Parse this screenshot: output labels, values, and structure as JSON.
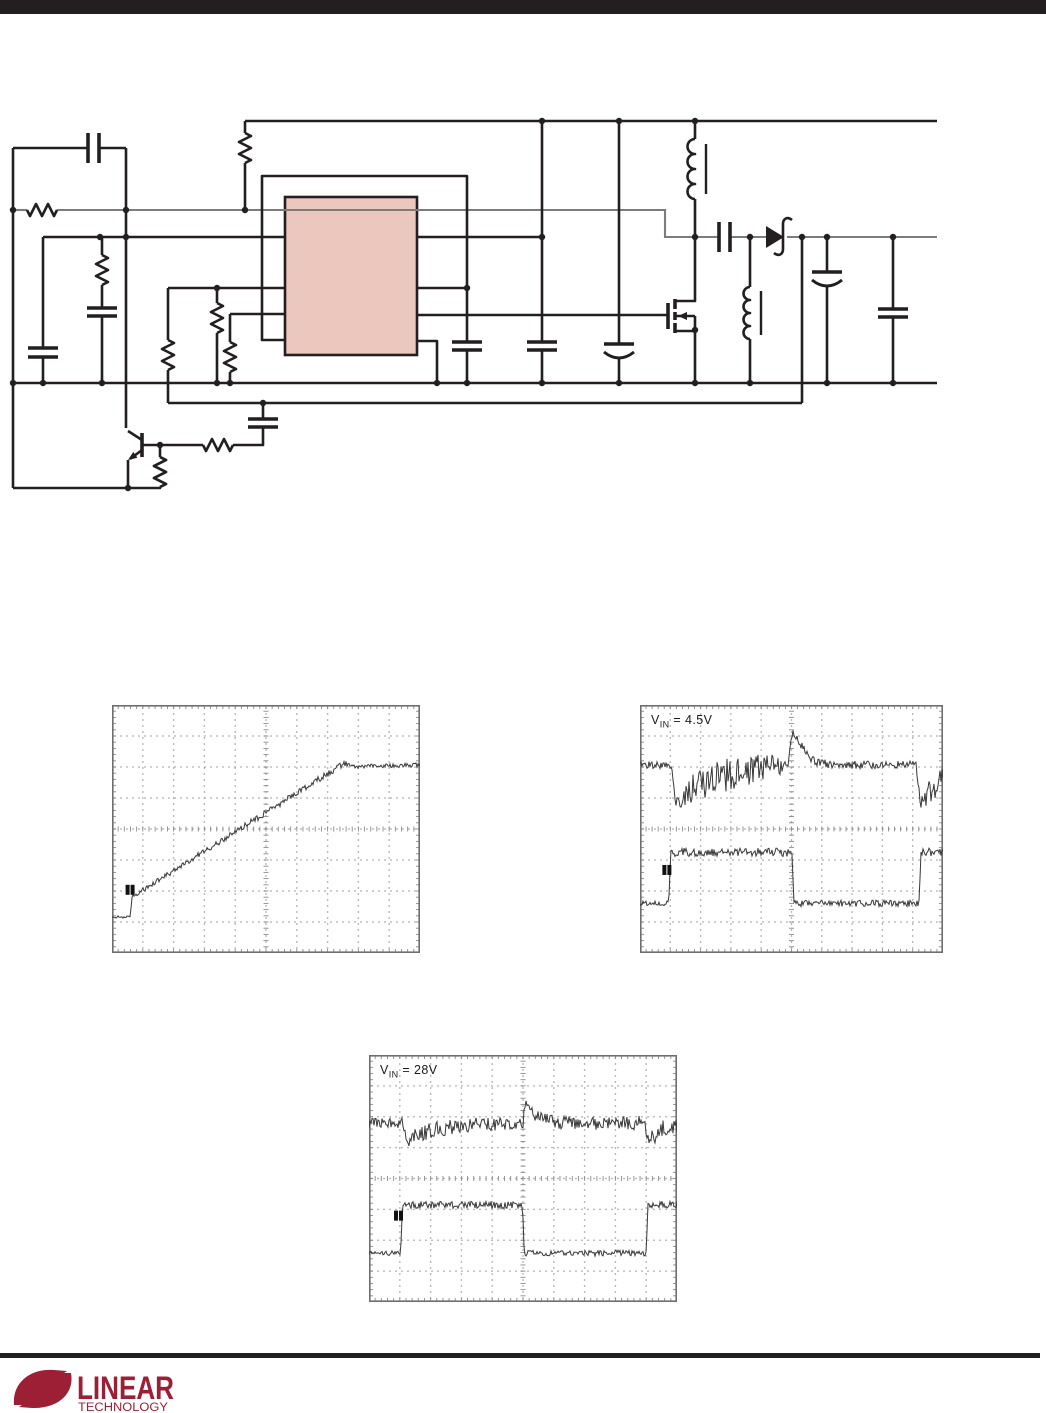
{
  "page": {
    "background": "#ffffff",
    "rule_color": "#231f20"
  },
  "schematic": {
    "ic_fill": "#EBC7BE",
    "wire_color": "#231f20",
    "highlight_net_color": "#7c7c7c",
    "description": "switching regulator application schematic, unlabeled"
  },
  "chart_data": [
    {
      "type": "line",
      "subtype": "oscilloscope",
      "name": "soft-start-ramp",
      "label": null,
      "divisions": {
        "cols": 10,
        "rows": 8
      },
      "grid": "dotted",
      "traces": [
        {
          "name": "output-ramp",
          "seed": 11,
          "points": [
            {
              "x": 0,
              "y": 0.855,
              "n": 0.006
            },
            {
              "x": 0.06,
              "y": 0.855,
              "n": 0.006
            },
            {
              "x": 0.064,
              "y": 0.775,
              "n": 0.01
            },
            {
              "x": 0.755,
              "y": 0.234,
              "n": 0.013
            },
            {
              "x": 0.775,
              "y": 0.248,
              "n": 0.008
            },
            {
              "x": 1,
              "y": 0.242,
              "n": 0.009
            }
          ]
        }
      ],
      "trigger": {
        "x": 0.062,
        "y": 0.725
      }
    },
    {
      "type": "line",
      "subtype": "oscilloscope",
      "name": "load-transient-vin-4p5",
      "label": {
        "v": "V",
        "sub": "IN",
        "rest": " = 4.5V"
      },
      "divisions": {
        "cols": 10,
        "rows": 8
      },
      "grid": "dotted",
      "traces": [
        {
          "name": "output-voltage",
          "seed": 23,
          "points": [
            {
              "x": 0,
              "y": 0.242,
              "n": 0.014
            },
            {
              "x": 0.105,
              "y": 0.242,
              "n": 0.014
            },
            {
              "x": 0.118,
              "y": 0.395,
              "n": 0.025
            },
            {
              "x": 0.16,
              "y": 0.35,
              "n": 0.06
            },
            {
              "x": 0.27,
              "y": 0.285,
              "n": 0.068
            },
            {
              "x": 0.42,
              "y": 0.25,
              "n": 0.055
            },
            {
              "x": 0.49,
              "y": 0.245,
              "n": 0.03
            },
            {
              "x": 0.503,
              "y": 0.105,
              "n": 0.015
            },
            {
              "x": 0.52,
              "y": 0.14,
              "n": 0.015
            },
            {
              "x": 0.57,
              "y": 0.225,
              "n": 0.018
            },
            {
              "x": 0.63,
              "y": 0.242,
              "n": 0.016
            },
            {
              "x": 0.912,
              "y": 0.242,
              "n": 0.016
            },
            {
              "x": 0.925,
              "y": 0.4,
              "n": 0.025
            },
            {
              "x": 0.95,
              "y": 0.36,
              "n": 0.055
            },
            {
              "x": 1,
              "y": 0.3,
              "n": 0.05
            }
          ]
        },
        {
          "name": "load-current-step",
          "seed": 31,
          "points": [
            {
              "x": 0,
              "y": 0.8,
              "n": 0.01
            },
            {
              "x": 0.095,
              "y": 0.8,
              "n": 0.01
            },
            {
              "x": 0.101,
              "y": 0.594,
              "n": 0.017
            },
            {
              "x": 0.502,
              "y": 0.594,
              "n": 0.017
            },
            {
              "x": 0.508,
              "y": 0.8,
              "n": 0.013
            },
            {
              "x": 0.921,
              "y": 0.8,
              "n": 0.013
            },
            {
              "x": 0.927,
              "y": 0.594,
              "n": 0.017
            },
            {
              "x": 1,
              "y": 0.594,
              "n": 0.017
            }
          ]
        }
      ],
      "trigger": {
        "x": 0.092,
        "y": 0.645
      }
    },
    {
      "type": "line",
      "subtype": "oscilloscope",
      "name": "load-transient-vin-28",
      "label": {
        "v": "V",
        "sub": "IN",
        "rest": " = 28V"
      },
      "divisions": {
        "cols": 10,
        "rows": 8
      },
      "grid": "dotted",
      "traces": [
        {
          "name": "output-voltage",
          "seed": 43,
          "points": [
            {
              "x": 0,
              "y": 0.275,
              "n": 0.02
            },
            {
              "x": 0.11,
              "y": 0.275,
              "n": 0.02
            },
            {
              "x": 0.125,
              "y": 0.34,
              "n": 0.03
            },
            {
              "x": 0.21,
              "y": 0.3,
              "n": 0.034
            },
            {
              "x": 0.36,
              "y": 0.283,
              "n": 0.03
            },
            {
              "x": 0.5,
              "y": 0.272,
              "n": 0.024
            },
            {
              "x": 0.508,
              "y": 0.185,
              "n": 0.015
            },
            {
              "x": 0.535,
              "y": 0.24,
              "n": 0.024
            },
            {
              "x": 0.62,
              "y": 0.275,
              "n": 0.028
            },
            {
              "x": 0.895,
              "y": 0.275,
              "n": 0.028
            },
            {
              "x": 0.91,
              "y": 0.345,
              "n": 0.03
            },
            {
              "x": 0.95,
              "y": 0.3,
              "n": 0.034
            },
            {
              "x": 1,
              "y": 0.285,
              "n": 0.03
            }
          ]
        },
        {
          "name": "load-current-step",
          "seed": 57,
          "points": [
            {
              "x": 0,
              "y": 0.802,
              "n": 0.01
            },
            {
              "x": 0.103,
              "y": 0.802,
              "n": 0.01
            },
            {
              "x": 0.109,
              "y": 0.607,
              "n": 0.015
            },
            {
              "x": 0.498,
              "y": 0.607,
              "n": 0.015
            },
            {
              "x": 0.504,
              "y": 0.802,
              "n": 0.012
            },
            {
              "x": 0.9,
              "y": 0.802,
              "n": 0.012
            },
            {
              "x": 0.906,
              "y": 0.607,
              "n": 0.015
            },
            {
              "x": 1,
              "y": 0.607,
              "n": 0.015
            }
          ]
        }
      ],
      "trigger": {
        "x": 0.099,
        "y": 0.63
      }
    }
  ],
  "logo": {
    "brand": "LINEAR",
    "sub": "TECHNOLOGY",
    "color": "#9D1F35"
  }
}
